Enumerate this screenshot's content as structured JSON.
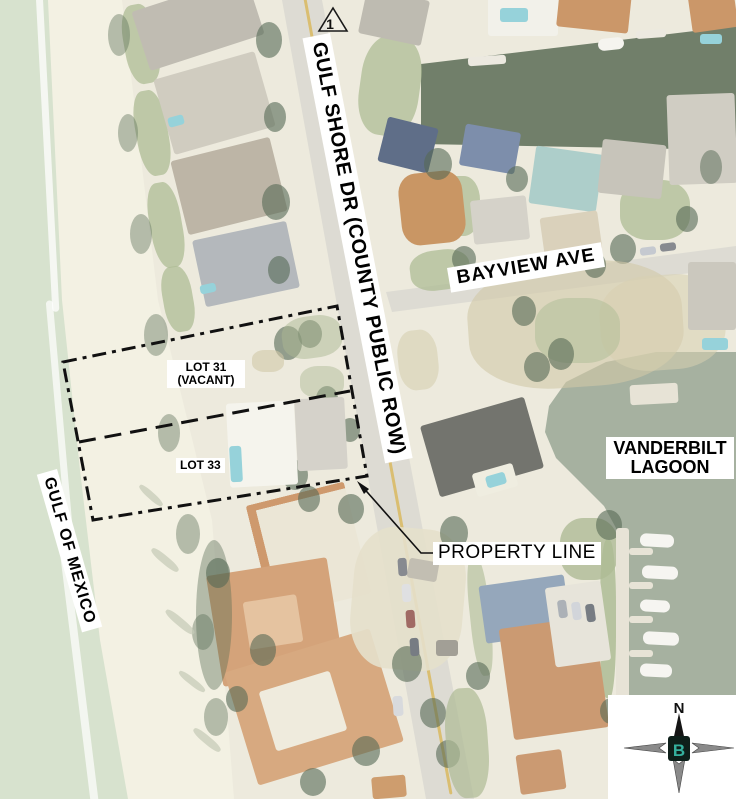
{
  "labels": {
    "street": "GULF SHORE DR (COUNTY PUBLIC ROW)",
    "cross_street": "BAYVIEW AVE",
    "gulf": "GULF OF MEXICO",
    "lagoon_line1": "VANDERBILT",
    "lagoon_line2": "LAGOON",
    "lot31_line1": "LOT 31",
    "lot31_line2": "(VACANT)",
    "lot33": "LOT 33",
    "property_line": "PROPERTY LINE",
    "marker_number": "1"
  },
  "compass": {
    "north_label": "N",
    "center_mark": "B"
  },
  "colors": {
    "base_ground": "#e9e6d6",
    "beach_sand": "#f1eedd",
    "gulf_water": "#cfdcc4",
    "lagoon_water": "#93a08c",
    "canal_water": "#52634a",
    "road": "#d6d4ca",
    "road_centerline_yellow": "#d2b052",
    "annotation_line": "#111111",
    "label_background": "#ffffff",
    "label_text": "#000000",
    "roof_orange": "#c08048",
    "vegetation": "#324a30"
  }
}
